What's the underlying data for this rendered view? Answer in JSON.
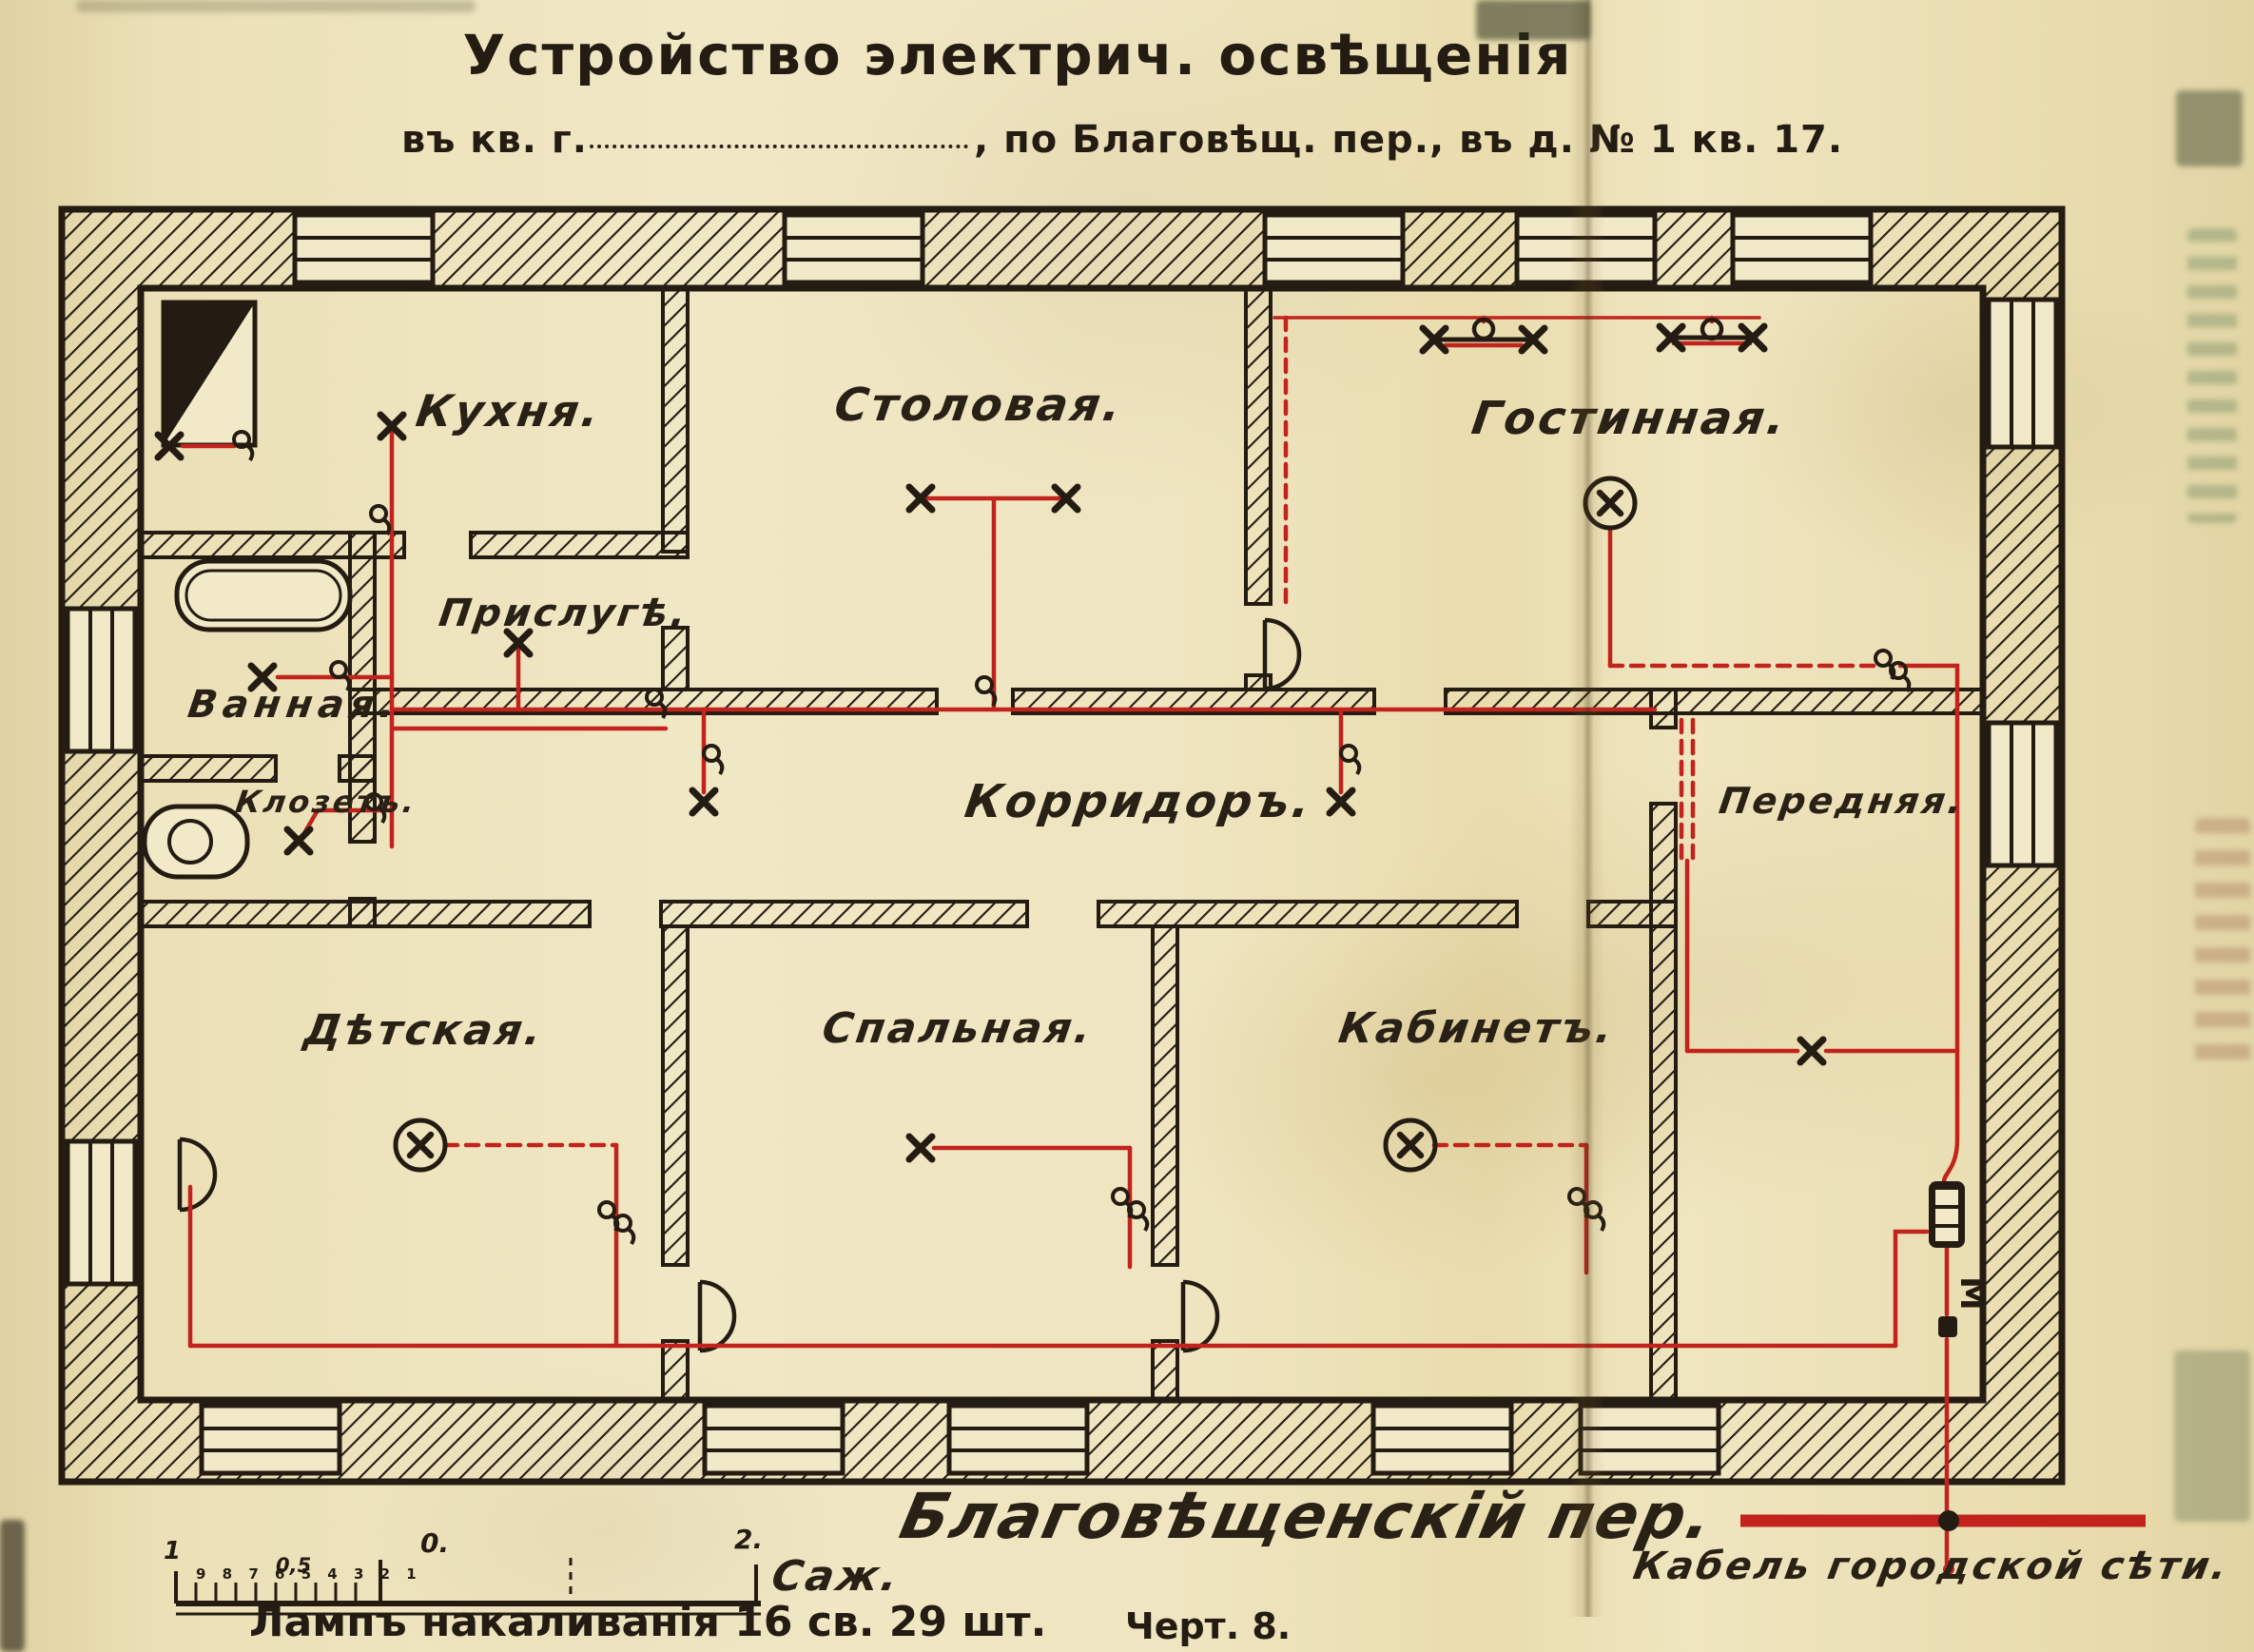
{
  "header": {
    "title": "Устройство электрич. освѣщенія",
    "line2_prefix": "въ кв. г.",
    "line2_suffix": ", по Благовѣщ. пер., въ д. № 1  кв. 17."
  },
  "rooms": {
    "kitchen": "Кухня.",
    "dining": "Столовая.",
    "living": "Гостинная.",
    "servants": "Прислугѣ.",
    "bath": "Ванная.",
    "wc": "Клозетъ.",
    "corridor": "Корридоръ.",
    "hall": "Передняя.",
    "nursery": "Дѣтская.",
    "bedroom": "Спальная.",
    "study": "Кабинетъ."
  },
  "street_label": "Благовѣщенскій пер.",
  "scale": {
    "left_end": "1",
    "half": "0,5",
    "zero": "0.",
    "right_end": "2.",
    "unit": "Саж.",
    "tick_digits": "9 8 7 6 5 4 3 2 1"
  },
  "notes": {
    "lamps": "Лампъ накаливанія 16 св. 29 шт.",
    "drawing_no": "Черт. 8.",
    "cable": "Кабель городской сѣти."
  },
  "meter_label": "М",
  "colors": {
    "paper": "#ece1b8",
    "ink": "#241c12",
    "wire": "#c2231d"
  }
}
